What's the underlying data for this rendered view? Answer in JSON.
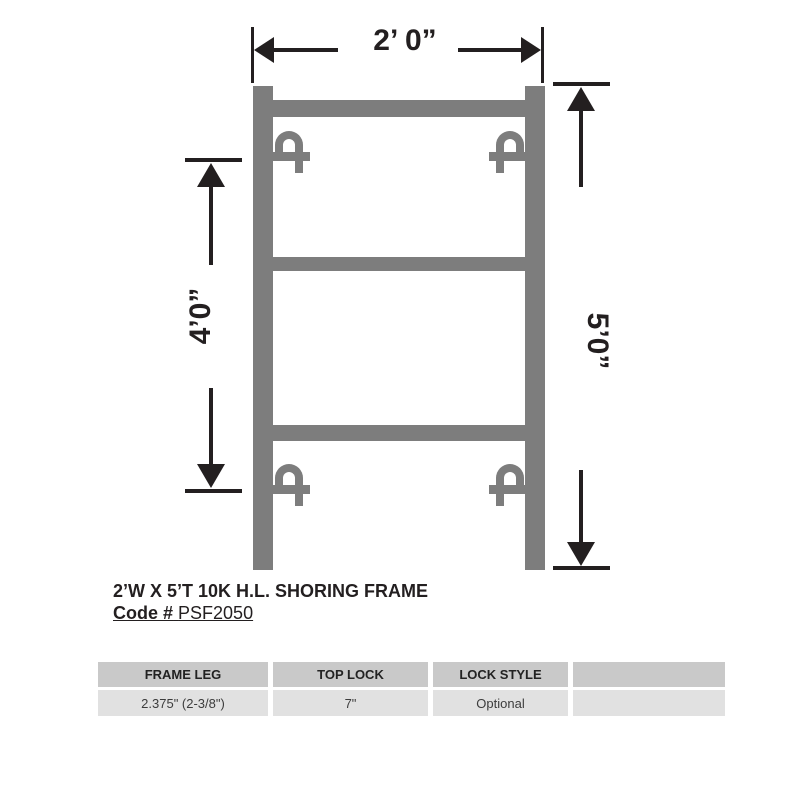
{
  "colors": {
    "frame-gray": "#7d7d7d",
    "line-black": "#231f20",
    "table-header-bg": "#c9c9c9",
    "table-row-bg": "#e1e1e1"
  },
  "dimensions": {
    "width_label": "2’ 0”",
    "panel_spacing_label": "4’0”",
    "overall_height_label": "5’0”"
  },
  "caption": {
    "title": "2’W X 5’T 10K H.L. SHORING FRAME",
    "code_label": "Code #",
    "code_value": "PSF2050"
  },
  "spec_table": {
    "headers": [
      "FRAME LEG",
      "TOP LOCK",
      "LOCK STYLE",
      ""
    ],
    "row": [
      "2.375\" (2-3/8\")",
      "7\"",
      "Optional",
      ""
    ]
  }
}
